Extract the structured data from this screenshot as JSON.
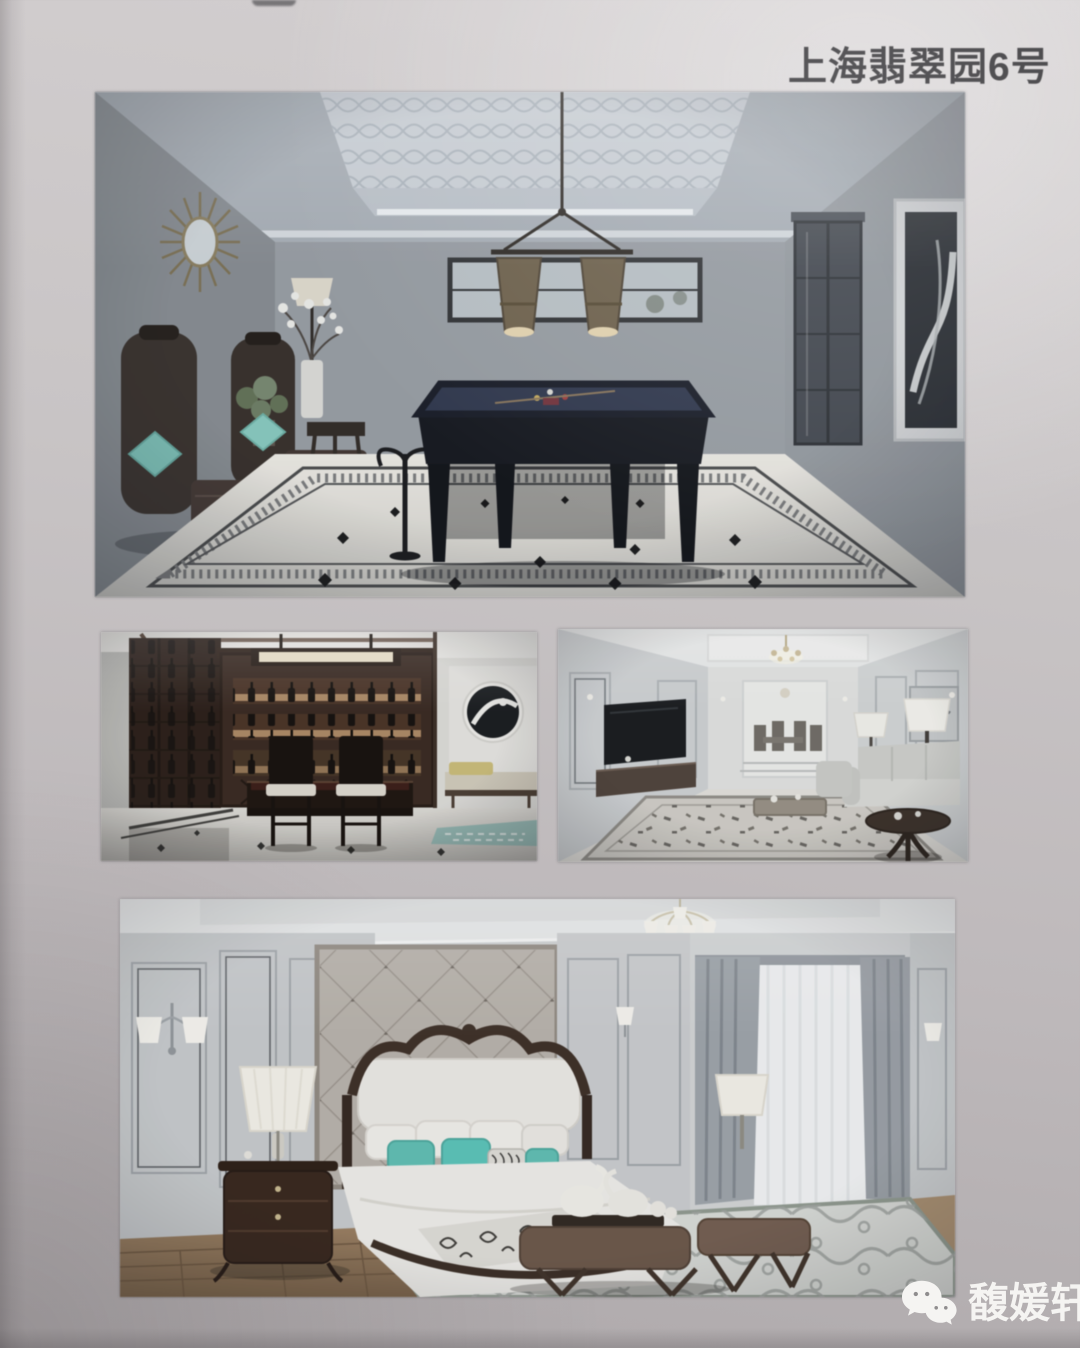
{
  "page": {
    "title": "上海翡翠园6号",
    "title_color": "#3e3d40",
    "background_color": "#c3bfc0",
    "kind": "photographed portfolio page with four interior renderings"
  },
  "photos": [
    {
      "id": "billiard-room",
      "alt": "Billiard room rendering: patterned tray ceiling, twin bronze pendant lamps, navy pool table, marble floor with black diamond inlay border, dark armchairs with teal pillows, sunburst mirror, glass cabinet and framed art"
    },
    {
      "id": "wine-bar",
      "alt": "Dark wood home wine bar rendering: backlit bottle shelving, bar counter with two high-back stools, linear pendant light, adjacent room with round artwork, yellow-cushion daybed and teal rug"
    },
    {
      "id": "living-room",
      "alt": "Light panelled living room rendering: wall TV and console on left, dining area beyond, sofas with white table lamps on right, dark round side table, patterned rug"
    },
    {
      "id": "bedroom",
      "alt": "Bedroom rendering: diamond-tufted headboard wall, ornate bed with white bedding and teal pillows, dark bombé nightstand with lamp, grey drapes with white sheer, leather bench with swan towels, wavy-pattern rug on wood floor"
    }
  ],
  "watermark": {
    "brand": "馥媛轩",
    "icon": "wechat-icon",
    "text_color": "#ffffff"
  },
  "palette": {
    "paper_grey": "#c3bfc0",
    "title_text": "#3e3d40",
    "teal_accent": "#5cc4b8",
    "billiard_felt": "#2b3550",
    "dark_wood": "#31201a",
    "watermark_white": "#f5f4f2"
  }
}
